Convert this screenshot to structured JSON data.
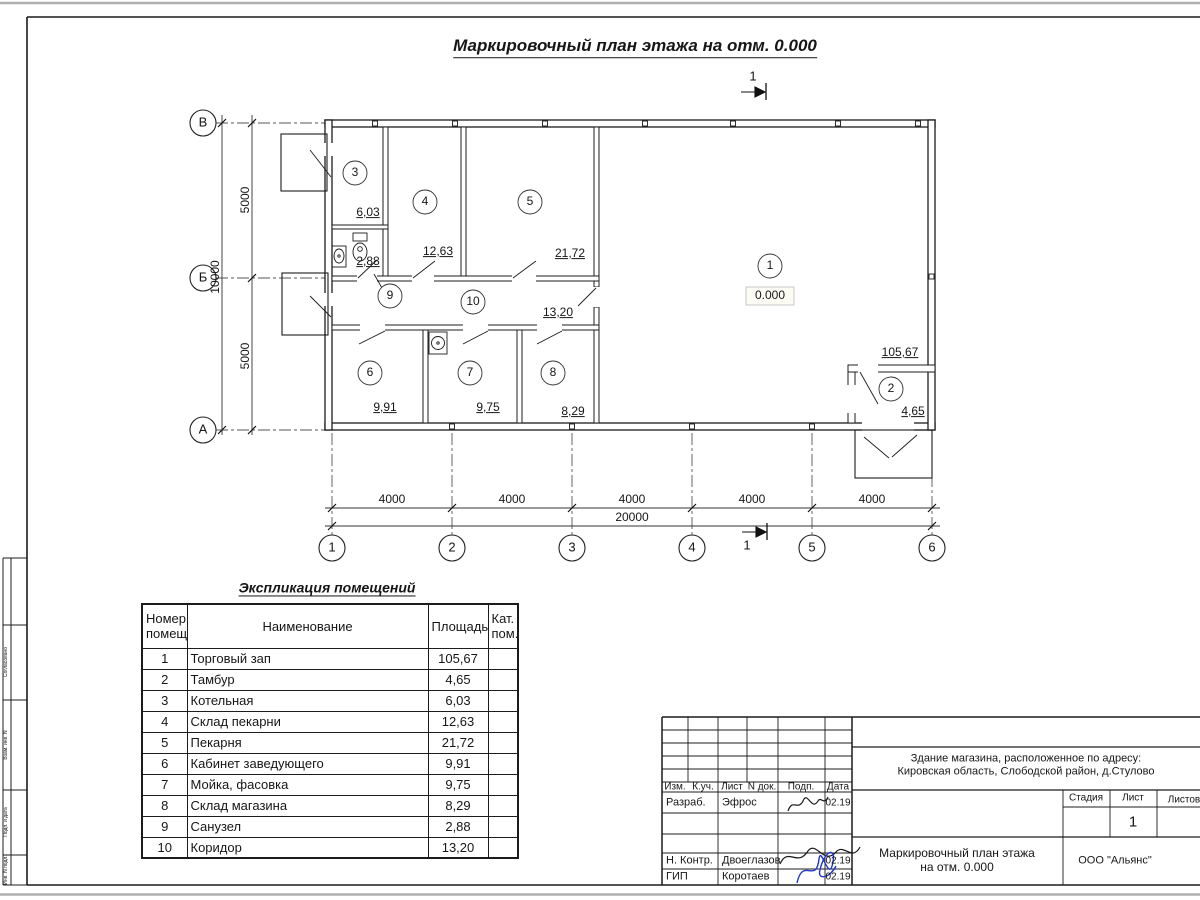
{
  "sheet_title": "Маркировочный план этажа на отм. 0.000",
  "plan": {
    "level_mark": "0.000",
    "section_label": "1",
    "axes_row": [
      "1",
      "2",
      "3",
      "4",
      "5",
      "6"
    ],
    "axes_col": [
      "В",
      "Б",
      "А"
    ],
    "dims_horizontal": [
      "4000",
      "4000",
      "4000",
      "4000",
      "4000"
    ],
    "dim_total_horizontal": "20000",
    "dims_vertical": [
      "5000",
      "5000"
    ],
    "dim_total_vertical": "10000",
    "rooms": [
      {
        "num": "1",
        "area": "105,67"
      },
      {
        "num": "2",
        "area": "4,65"
      },
      {
        "num": "3",
        "area": "6,03"
      },
      {
        "num": "4",
        "area": "12,63"
      },
      {
        "num": "5",
        "area": "21,72"
      },
      {
        "num": "6",
        "area": "9,91"
      },
      {
        "num": "7",
        "area": "9,75"
      },
      {
        "num": "8",
        "area": "8,29"
      },
      {
        "num": "9",
        "area": "2,88"
      },
      {
        "num": "10",
        "area": "13,20"
      }
    ]
  },
  "explication": {
    "title": "Экспликация помещений",
    "col_number": "Номер\nпомещ.",
    "col_name": "Наименование",
    "col_area": "Площадь",
    "col_cat": "Кат.\nпом.",
    "rows": [
      {
        "num": "1",
        "name": "Торговый зап",
        "area": "105,67",
        "cat": ""
      },
      {
        "num": "2",
        "name": "Тамбур",
        "area": "4,65",
        "cat": ""
      },
      {
        "num": "3",
        "name": "Котельная",
        "area": "6,03",
        "cat": ""
      },
      {
        "num": "4",
        "name": "Склад пекарни",
        "area": "12,63",
        "cat": ""
      },
      {
        "num": "5",
        "name": "Пекарня",
        "area": "21,72",
        "cat": ""
      },
      {
        "num": "6",
        "name": "Кабинет заведующего",
        "area": "9,91",
        "cat": ""
      },
      {
        "num": "7",
        "name": "Мойка, фасовка",
        "area": "9,75",
        "cat": ""
      },
      {
        "num": "8",
        "name": "Склад магазина",
        "area": "8,29",
        "cat": ""
      },
      {
        "num": "9",
        "name": "Санузел",
        "area": "2,88",
        "cat": ""
      },
      {
        "num": "10",
        "name": "Коридор",
        "area": "13,20",
        "cat": ""
      }
    ]
  },
  "title_block": {
    "object": "Здание магазина, расположенное по адресу:\nКировская область, Слободской район, д.Стулово",
    "doc_title": "Маркировочный план этажа\nна отм. 0.000",
    "company": "ООО \"Альянс\"",
    "stage_label": "Стадия",
    "sheet_label": "Лист",
    "sheets_label": "Листов",
    "sheet_value": "1",
    "header_cols": [
      "Изм.",
      "К.уч.",
      "Лист",
      "N док.",
      "Подп.",
      "Дата"
    ],
    "rows": {
      "developed_label": "Разраб.",
      "developed_name": "Эфрос",
      "developed_date": "02.19",
      "ncontrol_label": "Н. Контр.",
      "ncontrol_name": "Двоеглазов",
      "ncontrol_date": "02.19",
      "gip_label": "ГИП",
      "gip_name": "Коротаев",
      "gip_date": "02.19"
    }
  },
  "side_stamp": {
    "labels": [
      "Согласовано",
      "Взам. инв. N",
      "Подп. и дата",
      "Инв. N подл."
    ]
  }
}
